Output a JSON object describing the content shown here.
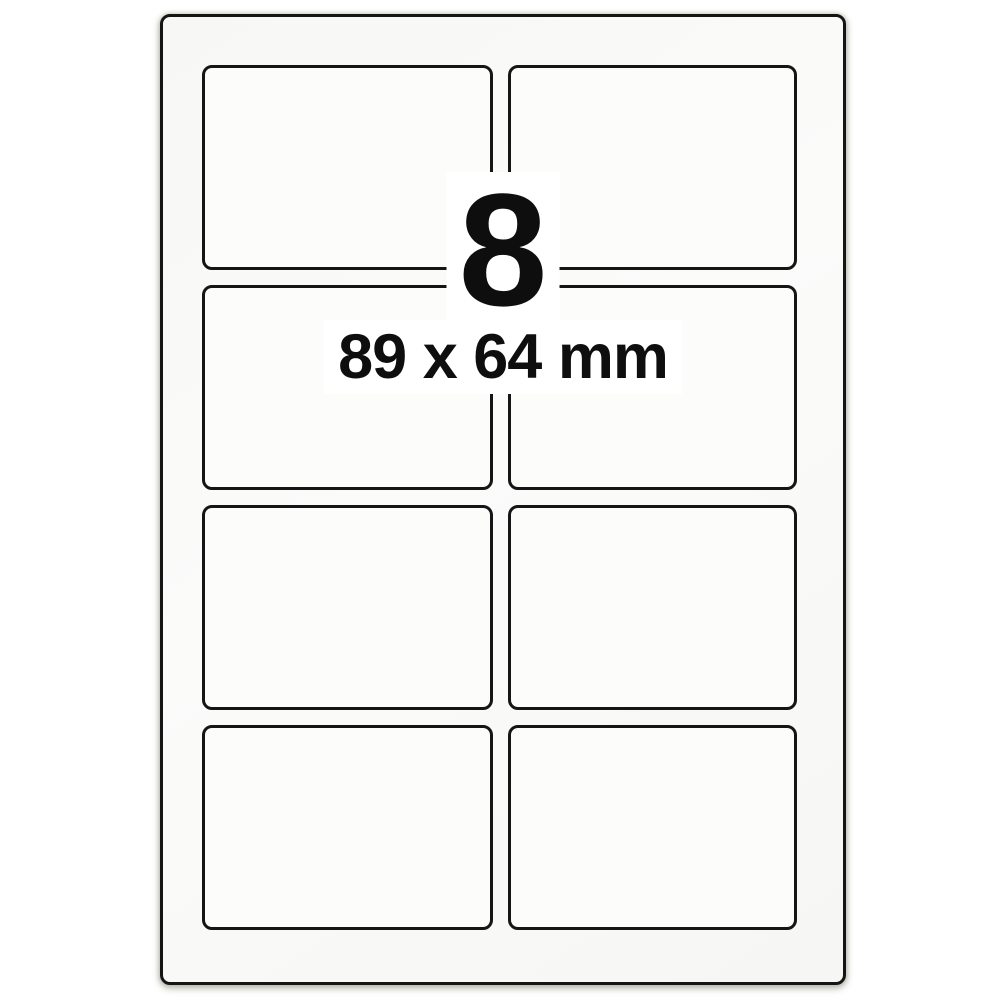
{
  "product": {
    "label_count": "8",
    "label_size": "89 x 64 mm"
  },
  "sheet": {
    "rows": 4,
    "columns": 2,
    "total_labels": 8
  },
  "colors": {
    "page_background": "#ffffff",
    "sheet_background": "#f9f9f7",
    "label_background": "#fcfcfb",
    "border": "#151515",
    "text": "#0e0e0e"
  }
}
